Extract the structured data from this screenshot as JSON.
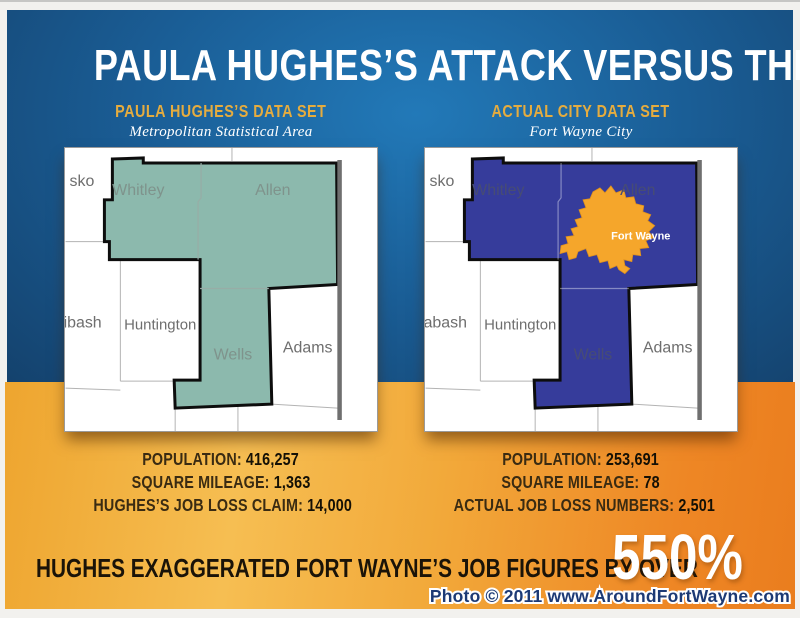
{
  "page": {
    "title": "PAULA HUGHES’S ATTACK VERSUS THE FACTS",
    "footer": {
      "headline": "HUGHES EXAGGERATED FORT WAYNE’S JOB FIGURES BY OVER",
      "percent": "550%",
      "watermark": "Photo © 2011 www.AroundFortWayne.com"
    }
  },
  "left_panel": {
    "heading": "PAULA HUGHES’S DATA SET",
    "subheading": "Metropolitan Statistical Area",
    "map": {
      "kosciusko": "sko",
      "whitley": "Whitley",
      "allen": "Allen",
      "wabash": "ibash",
      "huntington": "Huntington",
      "wells": "Wells",
      "adams": "Adams"
    },
    "stats": [
      {
        "label": "POPULATION:",
        "value": "416,257"
      },
      {
        "label": "SQUARE MILEAGE:",
        "value": "1,363"
      },
      {
        "label": "HUGHES’S JOB LOSS CLAIM:",
        "value": "14,000"
      }
    ]
  },
  "right_panel": {
    "heading": "ACTUAL CITY DATA SET",
    "subheading": "Fort Wayne City",
    "map": {
      "kosciusko": "sko",
      "whitley": "Whitley",
      "allen": "Allen",
      "wabash": "abash",
      "huntington": "Huntington",
      "wells": "Wells",
      "adams": "Adams",
      "fort_wayne": "Fort Wayne"
    },
    "stats": [
      {
        "label": "POPULATION:",
        "value": "253,691"
      },
      {
        "label": "SQUARE MILEAGE:",
        "value": "78"
      },
      {
        "label": "ACTUAL JOB LOSS NUMBERS:",
        "value": "2,501"
      }
    ]
  },
  "colors": {
    "msa_highlight_green": "#8CB9AD",
    "city_highlight_blue": "#363C9B",
    "fort_wayne_orange": "#F5A62B",
    "heading_gold": "#E5AC3F",
    "panel_blue": "#16497C",
    "band_orange": "#EE8725"
  }
}
